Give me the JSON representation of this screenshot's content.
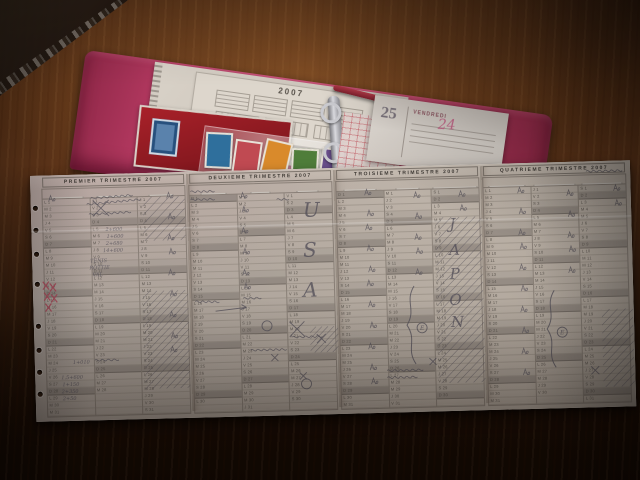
{
  "folder": {
    "accent_color": "#c2476f",
    "year_card": {
      "title": "2007"
    },
    "stamp_colors": [
      "#2f6f9c",
      "#c04a52",
      "#d98a2b",
      "#4f7d3a",
      "#6a4f8c",
      "#caa23a"
    ],
    "diary_page": {
      "day_number": "25",
      "day_name": "VENDREDI",
      "handwritten_note": "24"
    }
  },
  "sheet": {
    "paper_color": "#d6d0cb",
    "dow_letters": [
      "L",
      "M",
      "M",
      "J",
      "V",
      "S",
      "D"
    ],
    "trimesters": [
      {
        "title": "PREMIER TRIMESTRE 2007",
        "months": [
          {
            "name": "JANVIER",
            "days": 31,
            "start_dow": 0
          },
          {
            "name": "FEVRIER",
            "days": 28,
            "start_dow": 3
          },
          {
            "name": "MARS",
            "days": 31,
            "start_dow": 3
          }
        ]
      },
      {
        "title": "DEUXIEME TRIMESTRE 2007",
        "months": [
          {
            "name": "AVRIL",
            "days": 30,
            "start_dow": 6
          },
          {
            "name": "MAI",
            "days": 31,
            "start_dow": 1
          },
          {
            "name": "JUIN",
            "days": 30,
            "start_dow": 4
          }
        ]
      },
      {
        "title": "TROISIEME TRIMESTRE 2007",
        "months": [
          {
            "name": "JUILLET",
            "days": 31,
            "start_dow": 6
          },
          {
            "name": "AOUT",
            "days": 31,
            "start_dow": 2
          },
          {
            "name": "SEPTEMBRE",
            "days": 30,
            "start_dow": 5
          }
        ]
      },
      {
        "title": "QUATRIEME TRIMESTRE 2007",
        "months": [
          {
            "name": "OCTOBRE",
            "days": 31,
            "start_dow": 0
          },
          {
            "name": "NOVEMBRE",
            "days": 30,
            "start_dow": 3
          },
          {
            "name": "DECEMBRE",
            "days": 31,
            "start_dow": 5
          }
        ]
      }
    ]
  },
  "annotations": {
    "pencil_color": "#55515a",
    "red_color": "#a84355",
    "letters": [
      {
        "t": "U",
        "x": 272,
        "y": 48,
        "s": 20
      },
      {
        "t": "S",
        "x": 271,
        "y": 88,
        "s": 20
      },
      {
        "t": "A",
        "x": 270,
        "y": 128,
        "s": 20
      },
      {
        "t": "J",
        "x": 418,
        "y": 64,
        "s": 15
      },
      {
        "t": "A",
        "x": 417,
        "y": 90,
        "s": 15
      },
      {
        "t": "P",
        "x": 417,
        "y": 114,
        "s": 15
      },
      {
        "t": "O",
        "x": 416,
        "y": 140,
        "s": 15
      },
      {
        "t": "N",
        "x": 417,
        "y": 162,
        "s": 15
      }
    ],
    "texts": [
      {
        "t": "2+600",
        "x": 74,
        "y": 57
      },
      {
        "t": "1+600",
        "x": 75,
        "y": 64
      },
      {
        "t": "2+680",
        "x": 74,
        "y": 71
      },
      {
        "t": "14+600",
        "x": 71,
        "y": 78
      },
      {
        "t": "TENIS",
        "x": 58,
        "y": 88
      },
      {
        "t": "ROTTIE",
        "x": 57,
        "y": 95
      },
      {
        "t": "VAL",
        "x": 60,
        "y": 102
      },
      {
        "t": "1+010",
        "x": 38,
        "y": 189
      },
      {
        "t": "1,5+600",
        "x": 26,
        "y": 204
      },
      {
        "t": "1+150",
        "x": 27,
        "y": 211
      },
      {
        "t": "2+350",
        "x": 26,
        "y": 218
      },
      {
        "t": "2+50",
        "x": 27,
        "y": 225
      }
    ],
    "figures": [
      [
        18,
        20
      ],
      [
        136,
        20
      ],
      [
        137,
        41
      ],
      [
        136,
        62
      ],
      [
        137,
        76
      ],
      [
        136,
        97
      ],
      [
        137,
        118
      ],
      [
        136,
        139
      ],
      [
        137,
        160
      ],
      [
        136,
        174
      ],
      [
        210,
        22
      ],
      [
        211,
        36
      ],
      [
        210,
        57
      ],
      [
        211,
        78
      ],
      [
        210,
        99
      ],
      [
        211,
        113
      ],
      [
        334,
        22
      ],
      [
        336,
        43
      ],
      [
        334,
        57
      ],
      [
        335,
        78
      ],
      [
        336,
        99
      ],
      [
        334,
        113
      ],
      [
        335,
        134
      ],
      [
        336,
        155
      ],
      [
        334,
        176
      ],
      [
        335,
        197
      ],
      [
        336,
        211
      ],
      [
        383,
        26
      ],
      [
        384,
        47
      ],
      [
        383,
        68
      ],
      [
        384,
        82
      ],
      [
        383,
        103
      ],
      [
        428,
        26
      ],
      [
        429,
        40
      ],
      [
        487,
        24
      ],
      [
        488,
        45
      ],
      [
        487,
        66
      ],
      [
        488,
        80
      ],
      [
        487,
        101
      ],
      [
        488,
        122
      ],
      [
        487,
        143
      ],
      [
        488,
        164
      ],
      [
        487,
        185
      ],
      [
        488,
        206
      ],
      [
        536,
        28
      ],
      [
        537,
        49
      ],
      [
        536,
        70
      ],
      [
        537,
        84
      ],
      [
        536,
        105
      ],
      [
        583,
        24
      ],
      [
        584,
        39
      ]
    ],
    "hatches": [
      {
        "x": 110,
        "y": 118,
        "w": 45,
        "h": 98,
        "step": 7
      },
      {
        "x": 112,
        "y": 24,
        "w": 42,
        "h": 44,
        "step": 9
      },
      {
        "x": 404,
        "y": 52,
        "w": 46,
        "h": 166,
        "step": 8
      },
      {
        "x": 276,
        "y": 158,
        "w": 28,
        "h": 26,
        "step": 6
      },
      {
        "x": 568,
        "y": 148,
        "w": 31,
        "h": 78,
        "step": 8
      }
    ],
    "braces": [
      {
        "x": 376,
        "y1": 120,
        "y2": 198
      },
      {
        "x": 516,
        "y1": 128,
        "y2": 205
      }
    ],
    "circles": [
      {
        "x": 388,
        "y": 162,
        "t": "E"
      },
      {
        "x": 528,
        "y": 170,
        "t": "E"
      },
      {
        "x": 233,
        "y": 156,
        "t": ""
      },
      {
        "x": 271,
        "y": 215,
        "t": ""
      }
    ],
    "crosses_red": [
      [
        13,
        110
      ],
      [
        20,
        112
      ],
      [
        14,
        121
      ],
      [
        21,
        123
      ],
      [
        15,
        132
      ]
    ],
    "x_marks": [
      {
        "x": 70,
        "y": 34,
        "s": 16
      },
      {
        "x": 263,
        "y": 160,
        "s": 15
      },
      {
        "x": 287,
        "y": 170,
        "s": 9
      },
      {
        "x": 398,
        "y": 196,
        "s": 7
      },
      {
        "x": 560,
        "y": 209,
        "s": 8
      },
      {
        "x": 268,
        "y": 207,
        "s": 7
      },
      {
        "x": 240,
        "y": 188,
        "s": 7
      }
    ],
    "scribbles": [
      [
        56,
        30,
        56,
        -4
      ],
      [
        58,
        40,
        42,
        -2
      ],
      [
        60,
        24,
        40,
        -3
      ],
      [
        160,
        20,
        26,
        0
      ],
      [
        160,
        28,
        22,
        0
      ],
      [
        162,
        130,
        26,
        2
      ],
      [
        216,
        180,
        34,
        0
      ],
      [
        258,
        168,
        30,
        0
      ],
      [
        352,
        204,
        38,
        0
      ],
      [
        352,
        211,
        30,
        0
      ],
      [
        556,
        10,
        34,
        0
      ],
      [
        60,
        186,
        26,
        0
      ],
      [
        246,
        30,
        14,
        0
      ],
      [
        210,
        128,
        18,
        0
      ]
    ],
    "arrow": {
      "x1": 182,
      "y1": 140,
      "x2": 213,
      "y2": 137
    }
  }
}
